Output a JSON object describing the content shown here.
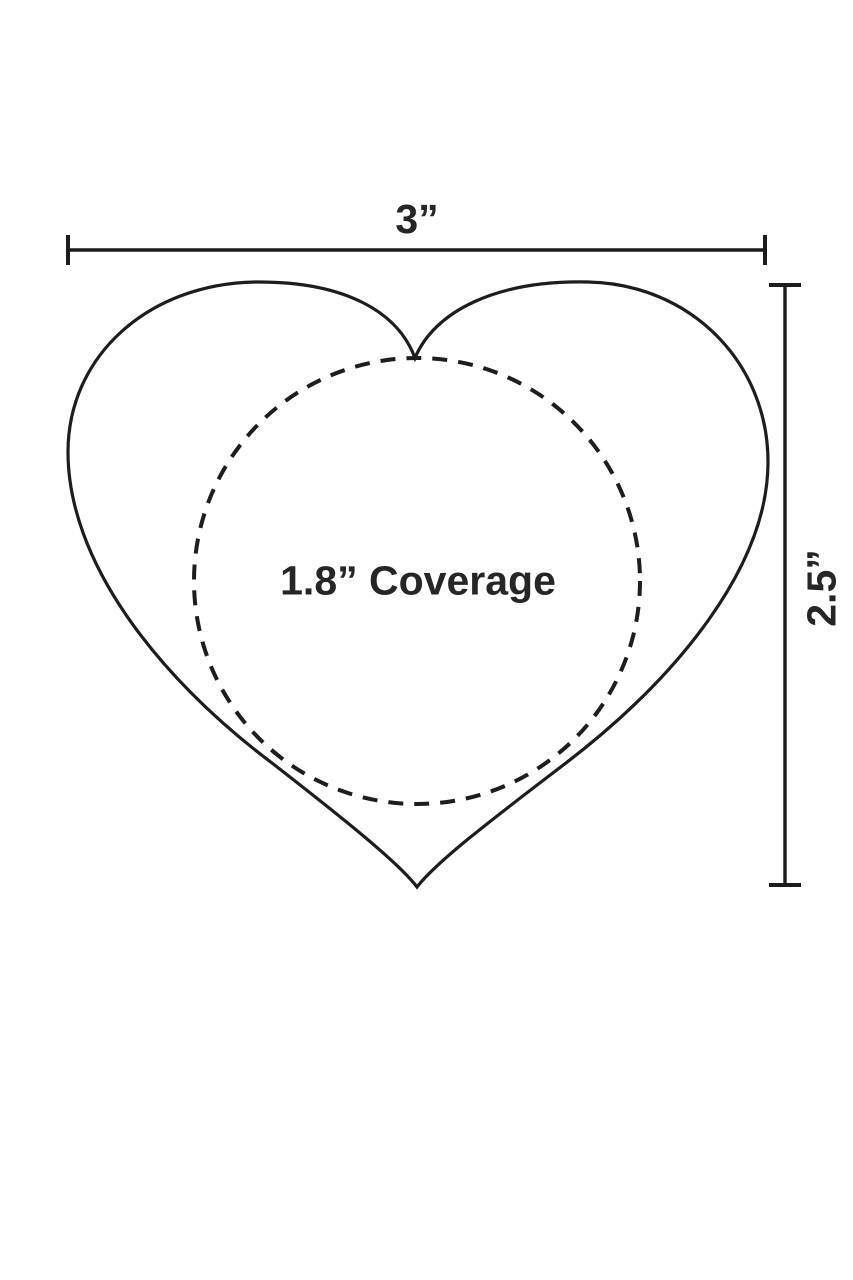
{
  "diagram": {
    "kind": "heart-size-dimension-diagram",
    "width_label": "3”",
    "height_label": "2.5”",
    "coverage_label": "1.8” Coverage",
    "colors": {
      "line": "#1d1d1d",
      "text": "#262626",
      "background": "#ffffff"
    }
  }
}
